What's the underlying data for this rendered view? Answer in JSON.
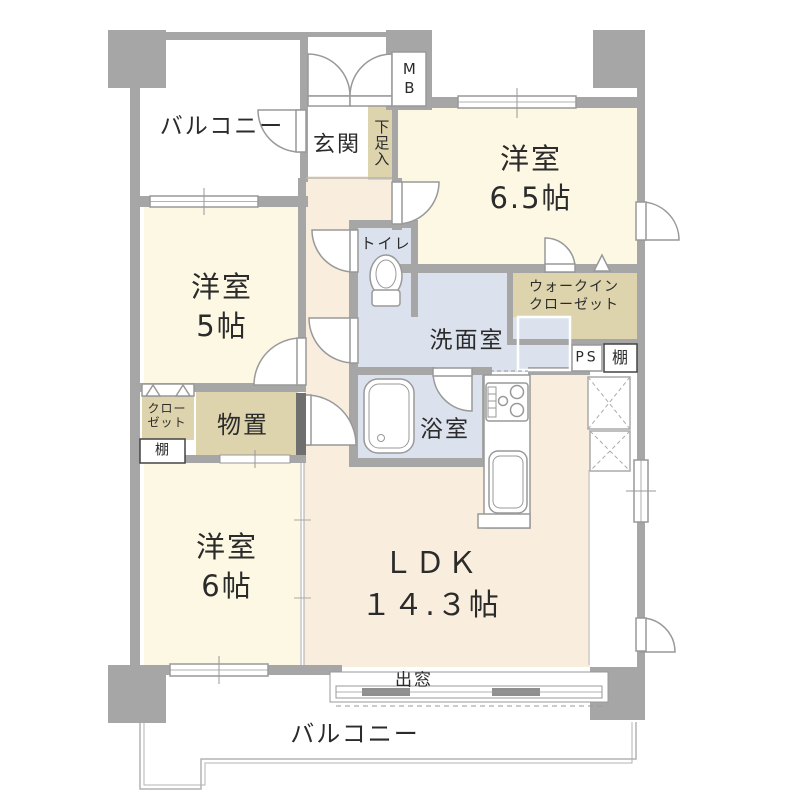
{
  "plan": {
    "title": "apartment-floor-plan",
    "rooms": {
      "balcony_top": {
        "label": "バルコニー"
      },
      "mb": {
        "label": "MB"
      },
      "genkan": {
        "label": "玄関"
      },
      "shoe_cabinet": {
        "label": "下足入"
      },
      "bedroom_65": {
        "label": "洋室",
        "size": "6.5帖"
      },
      "toilet": {
        "label": "トイレ"
      },
      "bedroom_5": {
        "label": "洋室",
        "size": "5帖"
      },
      "wic": {
        "label_line1": "ウォークイン",
        "label_line2": "クローゼット"
      },
      "washroom": {
        "label": "洗面室"
      },
      "ps": {
        "label": "PS"
      },
      "shelf_right": {
        "label": "棚"
      },
      "closet": {
        "label_line1": "クロー",
        "label_line2": "ゼット"
      },
      "shelf_left": {
        "label": "棚"
      },
      "storage": {
        "label": "物置"
      },
      "bathroom": {
        "label": "浴室"
      },
      "bedroom_6": {
        "label": "洋室",
        "size": "6帖"
      },
      "ldk": {
        "label": "ＬＤＫ",
        "size": "１４.３帖"
      },
      "bay_window": {
        "label": "出窓"
      },
      "balcony_bottom": {
        "label": "バルコニー"
      }
    },
    "colors": {
      "wall": "#a6a6a6",
      "cream": "#fcf8e3",
      "peach": "#f9eedd",
      "wet": "#dbe2ee",
      "beige": "#ddd3ad",
      "white": "#ffffff",
      "slider": "#6f6f6f",
      "line": "#999999",
      "rail": "#b3b3b3",
      "ink": "#2b2b2b"
    }
  }
}
